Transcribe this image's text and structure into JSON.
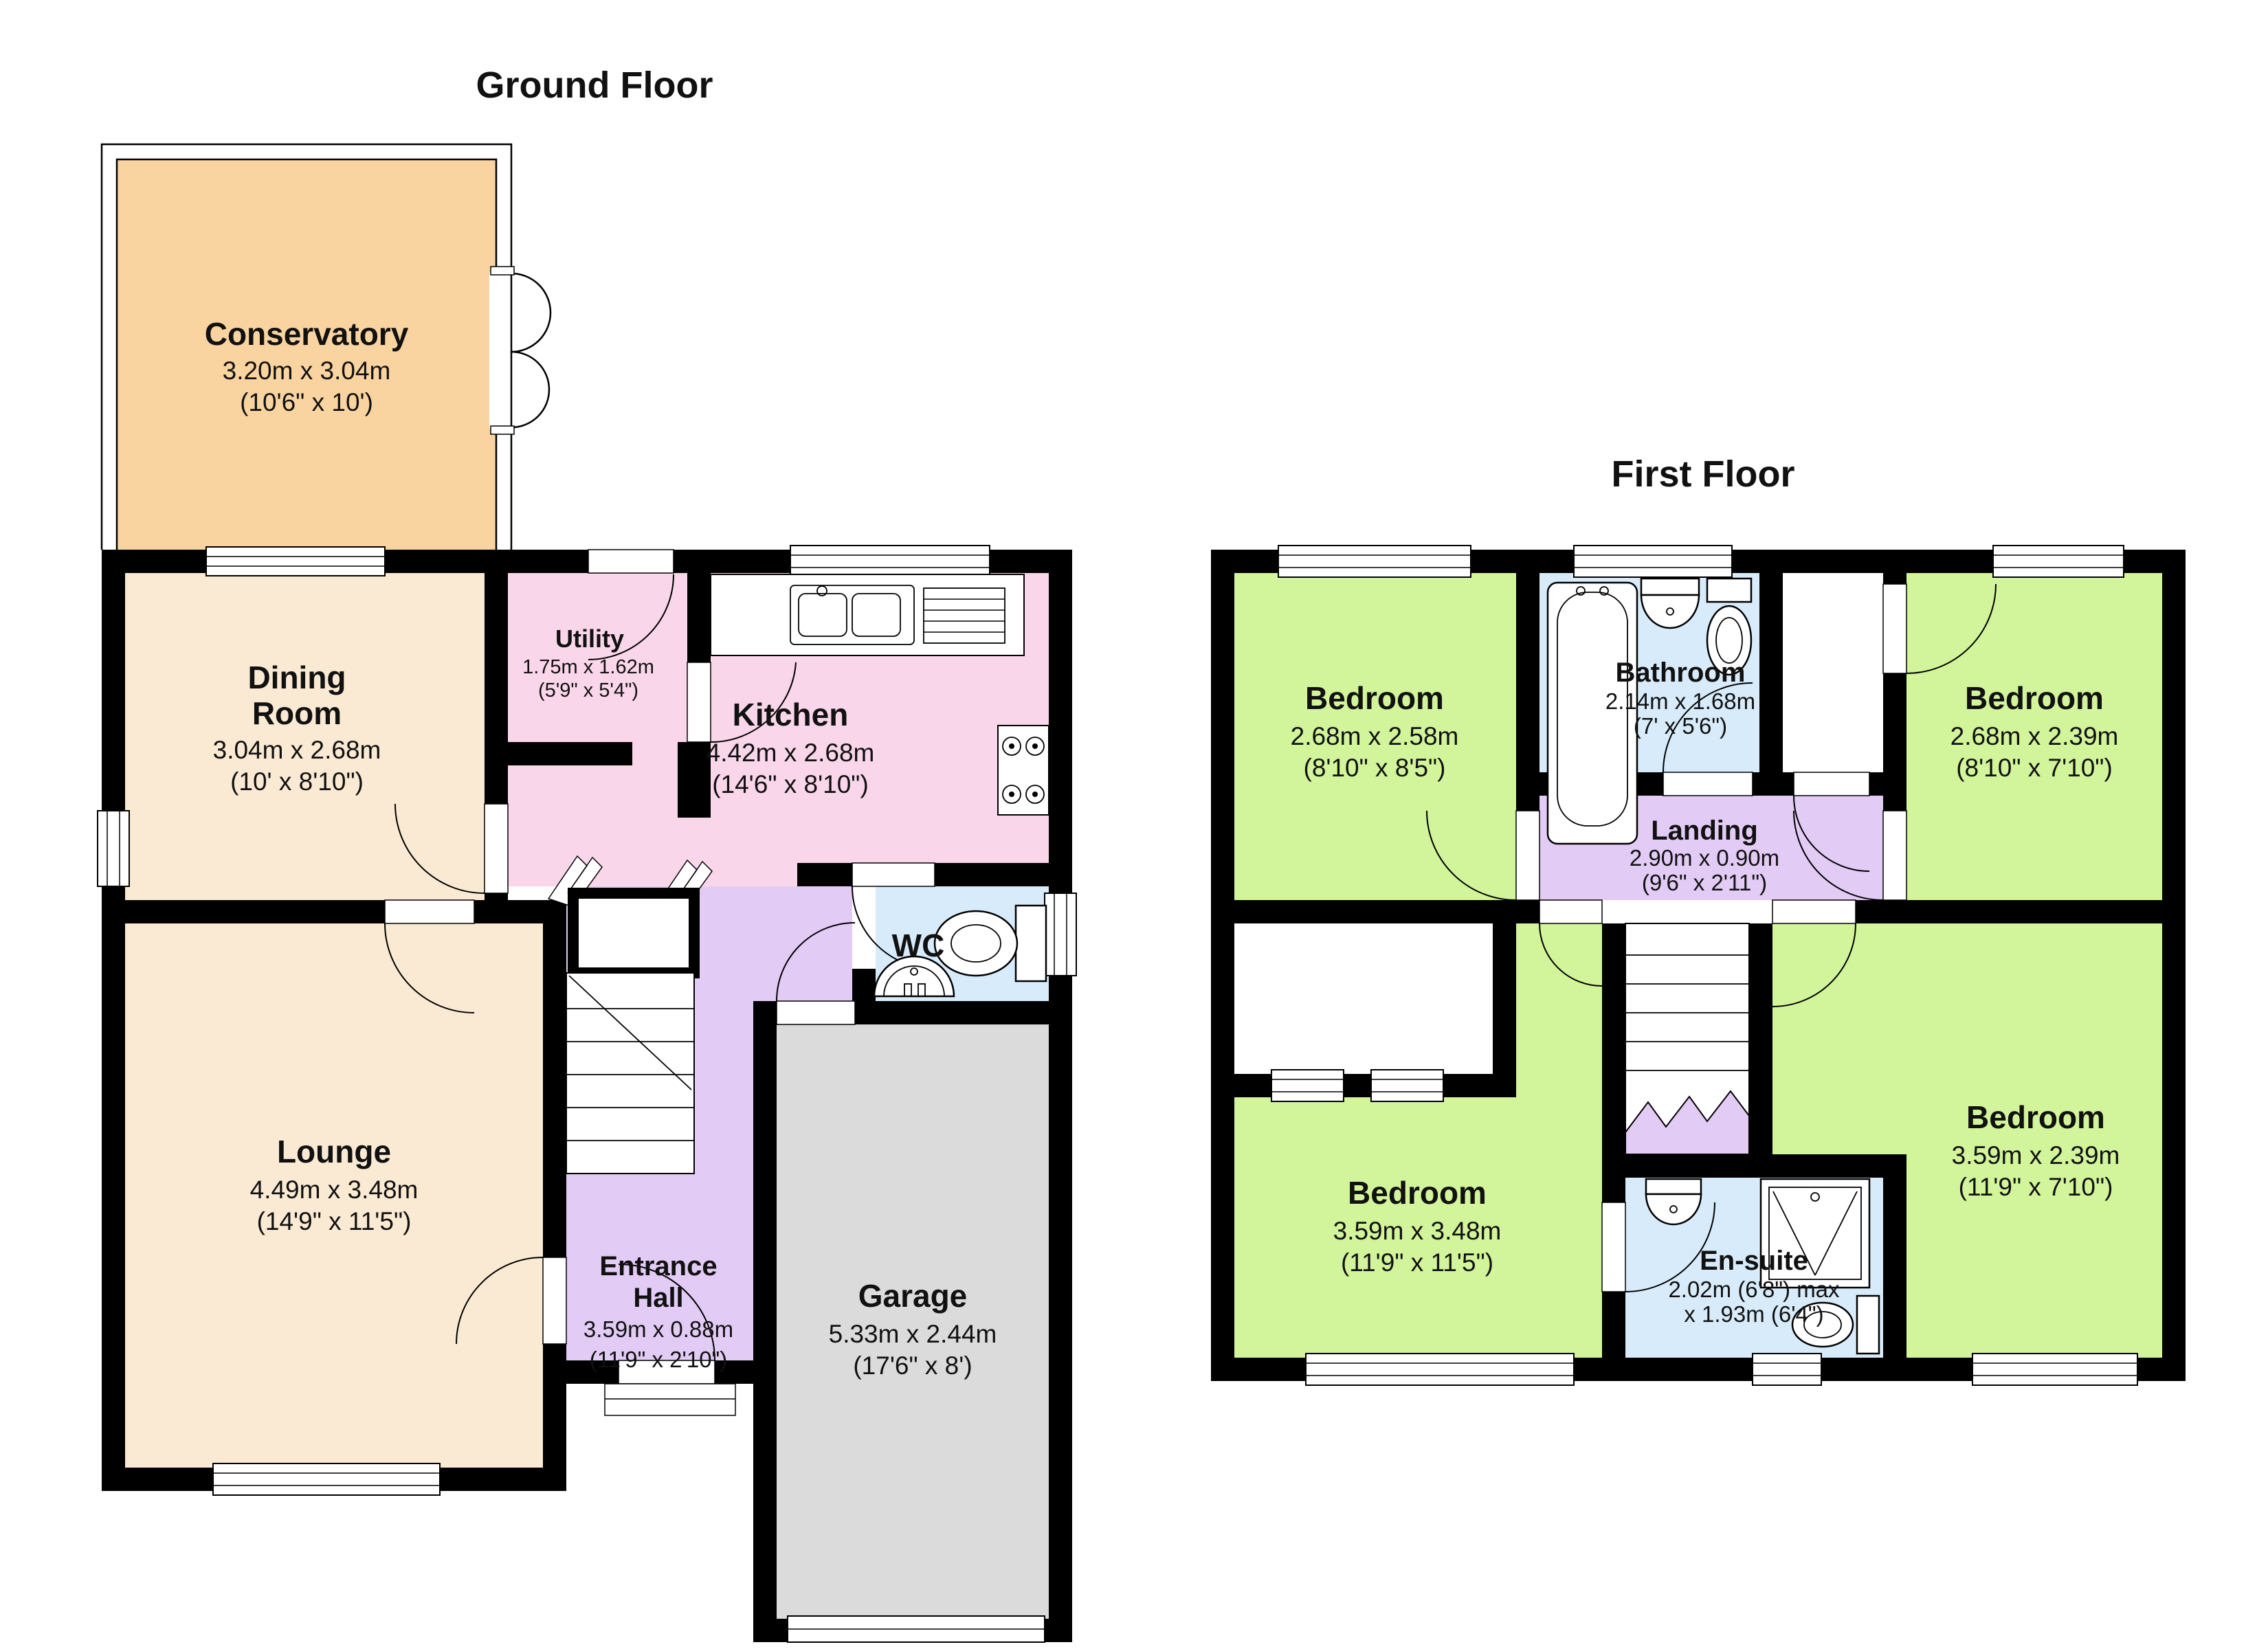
{
  "ground_floor": {
    "title": "Ground Floor",
    "rooms": {
      "conservatory": {
        "name": "Conservatory",
        "dims": [
          "3.20m x 3.04m",
          "(10'6\" x 10')"
        ]
      },
      "dining_room": {
        "name_lines": [
          "Dining",
          "Room"
        ],
        "dims": [
          "3.04m x 2.68m",
          "(10' x 8'10\")"
        ]
      },
      "utility": {
        "name": "Utility",
        "dims": [
          "1.75m x 1.62m",
          "(5'9\" x 5'4\")"
        ]
      },
      "kitchen": {
        "name": "Kitchen",
        "dims": [
          "4.42m x 2.68m",
          "(14'6\" x 8'10\")"
        ]
      },
      "wc": {
        "name": "WC",
        "dims": []
      },
      "lounge": {
        "name": "Lounge",
        "dims": [
          "4.49m x 3.48m",
          "(14'9\" x 11'5\")"
        ]
      },
      "entrance_hall": {
        "name_lines": [
          "Entrance",
          "Hall"
        ],
        "dims": [
          "3.59m x 0.88m",
          "(11'9\" x 2'10\")"
        ]
      },
      "garage": {
        "name": "Garage",
        "dims": [
          "5.33m x 2.44m",
          "(17'6\" x 8')"
        ]
      }
    }
  },
  "first_floor": {
    "title": "First Floor",
    "rooms": {
      "bedroom_1": {
        "name": "Bedroom",
        "dims": [
          "2.68m x 2.58m",
          "(8'10\" x 8'5\")"
        ]
      },
      "bathroom": {
        "name": "Bathroom",
        "dims": [
          "2.14m x 1.68m",
          "(7' x 5'6\")"
        ]
      },
      "bedroom_2": {
        "name": "Bedroom",
        "dims": [
          "2.68m x 2.39m",
          "(8'10\" x 7'10\")"
        ]
      },
      "landing": {
        "name": "Landing",
        "dims": [
          "2.90m x 0.90m",
          "(9'6\" x 2'11\")"
        ]
      },
      "bedroom_3": {
        "name": "Bedroom",
        "dims": [
          "3.59m x 3.48m",
          "(11'9\" x 11'5\")"
        ]
      },
      "en_suite": {
        "name": "En-suite",
        "dims": [
          "2.02m (6'8\") max",
          "x 1.93m (6'4\")"
        ]
      },
      "bedroom_4": {
        "name": "Bedroom",
        "dims": [
          "3.59m x 2.39m",
          "(11'9\" x 7'10\")"
        ]
      }
    }
  },
  "colors": {
    "wall": "#000000",
    "conservatory": "#FAD4A0",
    "cream": "#FAEAD3",
    "kitchen": "#F9D6E9",
    "hall": "#E2CBF4",
    "wet": "#D8EBFA",
    "bedroom": "#D2F49B",
    "garage": "#DBDBDB"
  }
}
